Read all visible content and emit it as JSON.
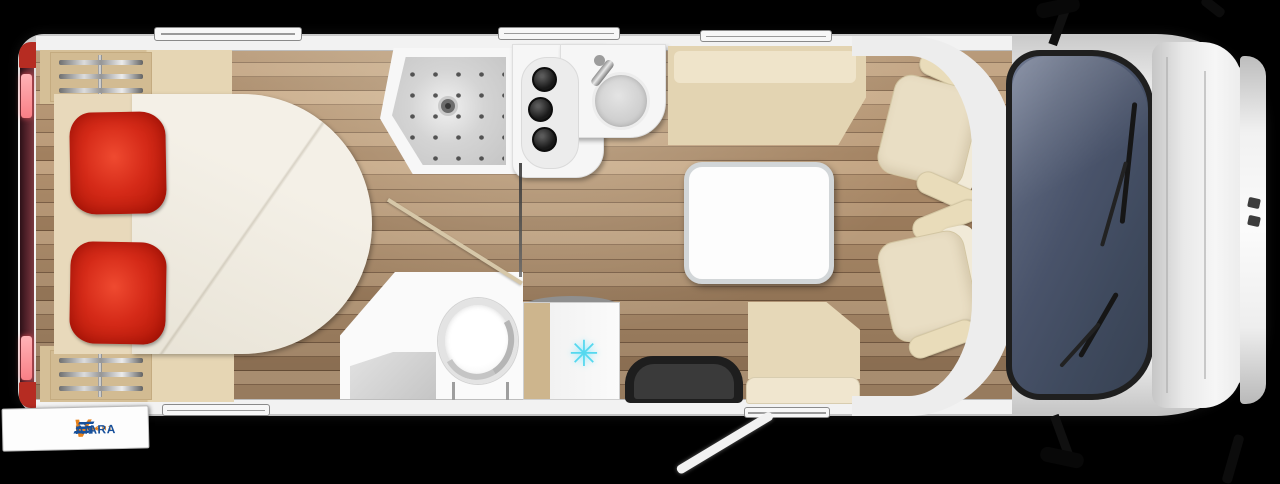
{
  "scene": {
    "description": "Top-down 3D floor plan of a motorhome with rear island bed, shower, kitchen, bathroom, fridge, dinette and driver cab",
    "background": "#000000"
  },
  "brand_badge": {
    "top_text": "Brecht",
    "cara": "Cara",
    "v": "V",
    "an": "an"
  },
  "fridge": {
    "snowflake_glyph": "✳"
  },
  "palette": {
    "pillow_red": "#d52a18",
    "snowflake_cyan": "#55d8ef",
    "logo_blue": "#17509b",
    "logo_orange": "#e8821b",
    "body_white": "#f2f2f2",
    "windshield_blue": "#465062",
    "wood_mid": "#a98a68",
    "taillight_pink": "#ff9aa1"
  }
}
